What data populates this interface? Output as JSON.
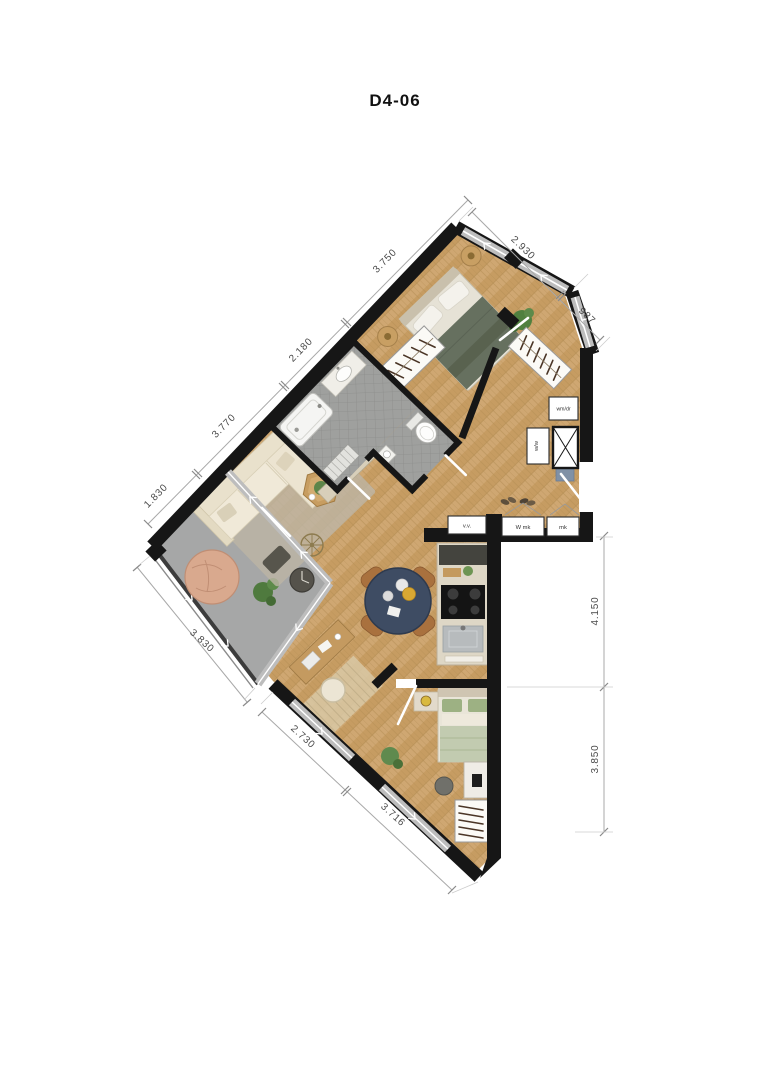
{
  "title": "D4-06",
  "dims": {
    "ne1": "2.930",
    "ne2": "987",
    "nw1": "3.750",
    "nw2": "2.180",
    "nw3": "3.770",
    "nw4": "1.830",
    "sw1": "3.830",
    "sw2": "2.730",
    "sw3": "3.716",
    "e1": "4.150",
    "e2": "3.850"
  },
  "labels": {
    "vv": "v.v.",
    "wmk": "W mk",
    "mk": "mk",
    "wmdr": "wm/dr",
    "ww": "w/w"
  },
  "colors": {
    "wall": "#161616",
    "wood_floor": "#cfa772",
    "tile_floor": "#9fa09e",
    "balcony_floor": "#a6a7a7",
    "window_band": "#bdbdbd",
    "dim_line": "#a8a8a8",
    "dim_text": "#4a4a4a",
    "dining_table": "#3e4c63",
    "sofa": "#ece4d1",
    "bed_blanket": "#66705f",
    "pouf": "#d9a98e"
  }
}
